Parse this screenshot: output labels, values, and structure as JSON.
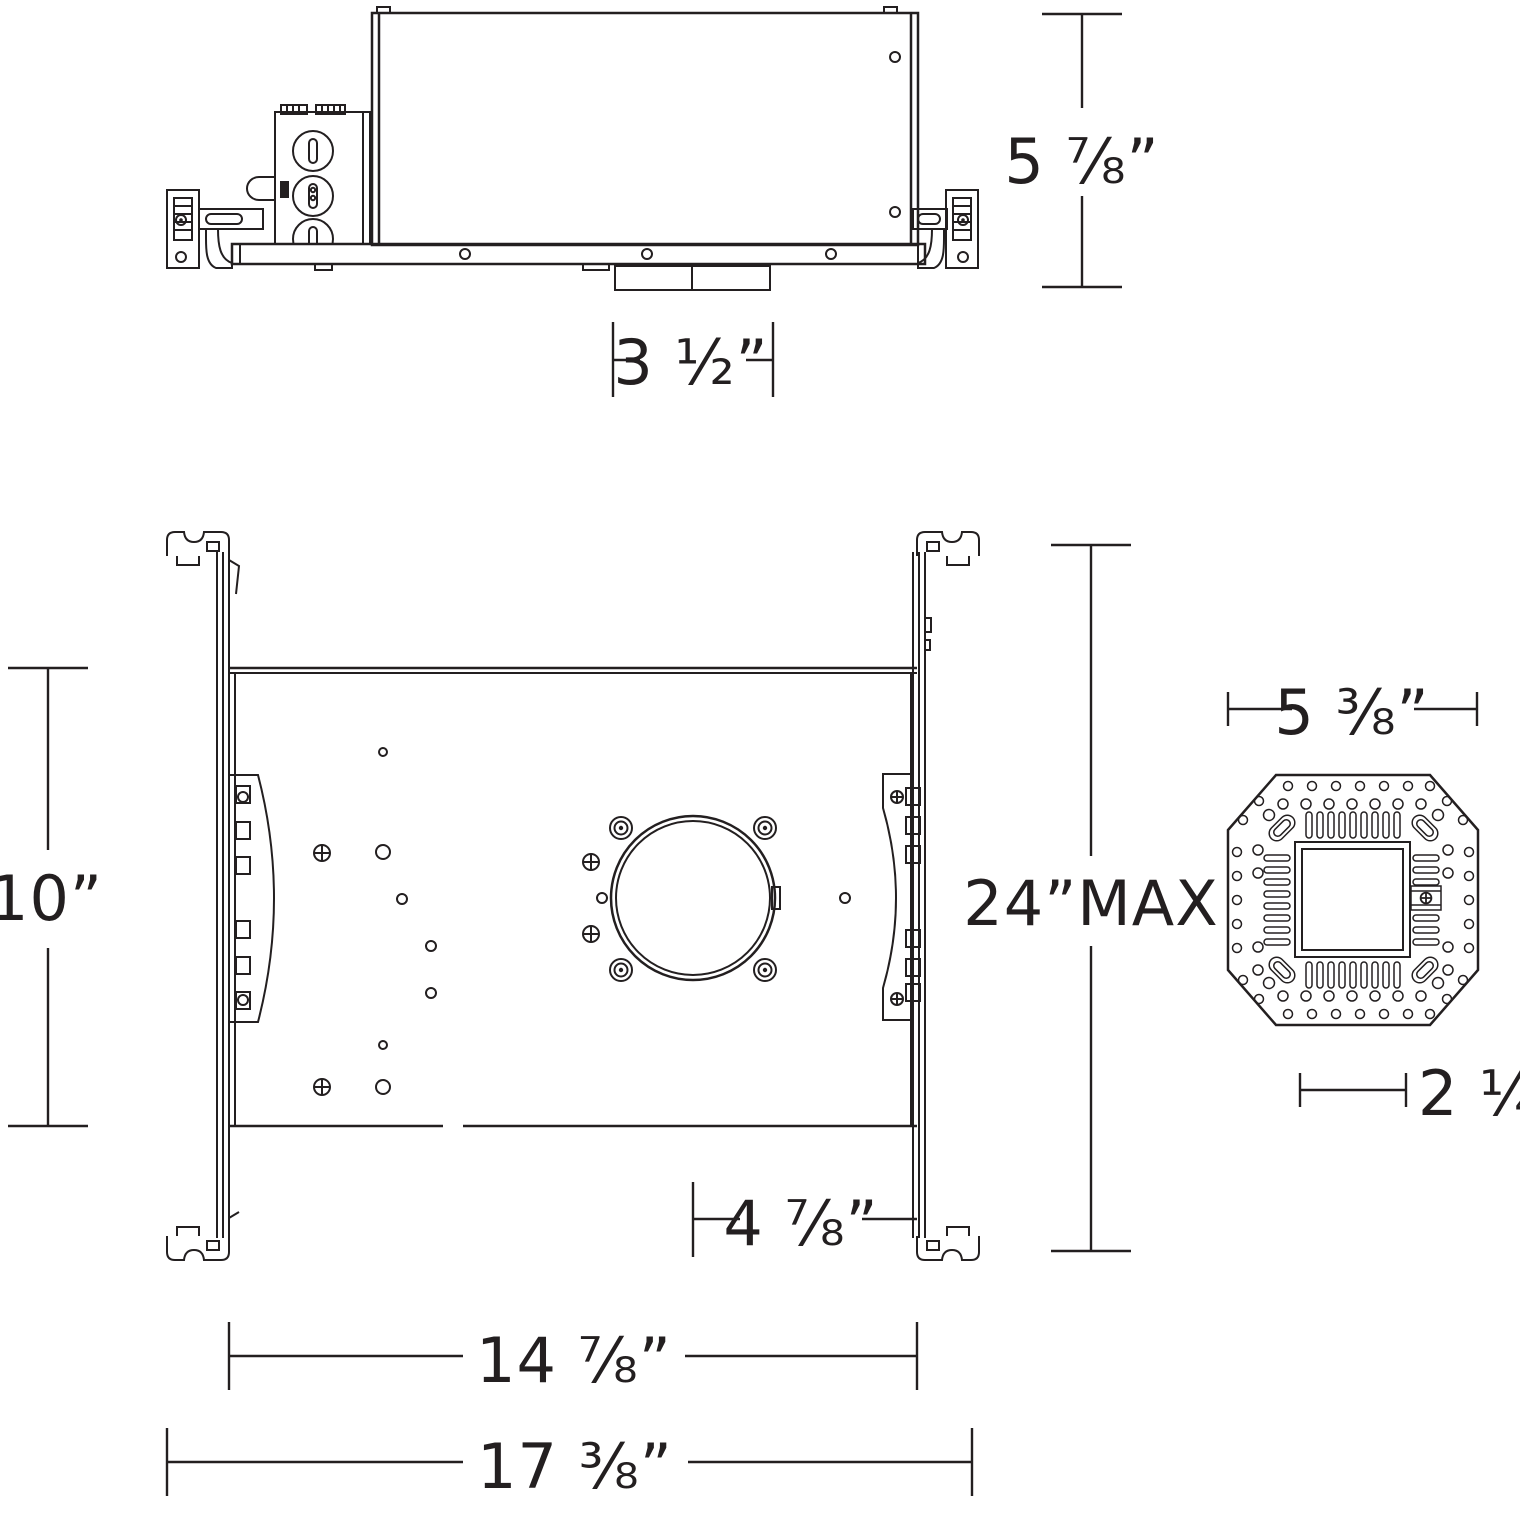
{
  "colors": {
    "ink": "#231f20",
    "paper": "#ffffff"
  },
  "views": {
    "side_view": {
      "dims": {
        "housing_height": "5 ⅞”",
        "collar_width": "3 ½”"
      }
    },
    "plan_view": {
      "dims": {
        "bracket_height": "10”",
        "hanger_bar_max": "24”MAX",
        "aperture_to_edge": "4 ⅞”",
        "pan_width": "14 ⅞”",
        "overall_width": "17 ⅜”"
      }
    },
    "module_view": {
      "dims": {
        "module_width": "5 ⅜”",
        "aperture_width": "2 ¼”"
      }
    }
  }
}
